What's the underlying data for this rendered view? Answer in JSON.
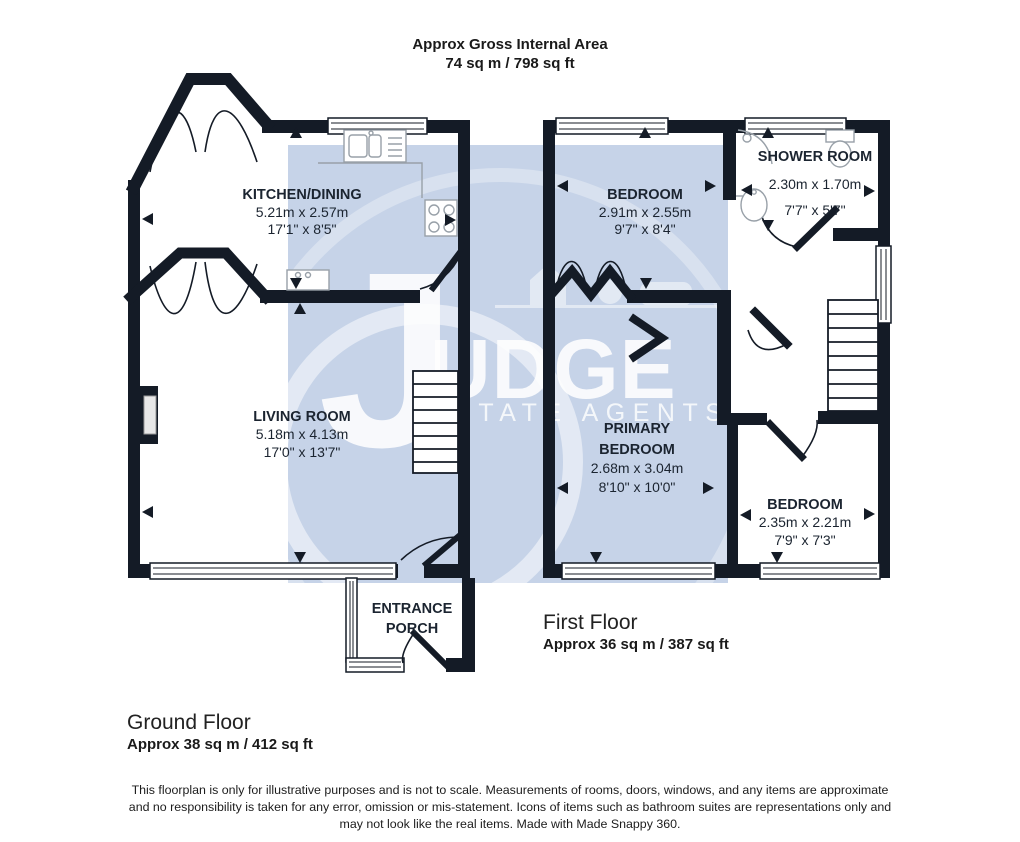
{
  "header": {
    "title": "Approx Gross Internal Area",
    "subtitle": "74 sq m / 798 sq ft"
  },
  "floors": {
    "ground": {
      "label": "Ground Floor",
      "area": "Approx 38 sq m / 412 sq ft"
    },
    "first": {
      "label": "First Floor",
      "area": "Approx 36 sq m / 387 sq ft"
    }
  },
  "rooms": {
    "kitchen": {
      "name": "KITCHEN/DINING",
      "metric": "5.21m x 2.57m",
      "imperial": "17'1\" x 8'5\""
    },
    "living": {
      "name": "LIVING ROOM",
      "metric": "5.18m x 4.13m",
      "imperial": "17'0\" x 13'7\""
    },
    "porch": {
      "name_line1": "ENTRANCE",
      "name_line2": "PORCH"
    },
    "bedroom1": {
      "name": "BEDROOM",
      "metric": "2.91m x 2.55m",
      "imperial": "9'7\" x 8'4\""
    },
    "shower": {
      "name": "SHOWER ROOM",
      "metric": "2.30m x 1.70m",
      "imperial": "7'7\" x 5'7\""
    },
    "primary": {
      "name_line1": "PRIMARY",
      "name_line2": "BEDROOM",
      "metric": "2.68m x 3.04m",
      "imperial": "8'10\" x 10'0\""
    },
    "bedroom2": {
      "name": "BEDROOM",
      "metric": "2.35m x 2.21m",
      "imperial": "7'9\" x 7'3\""
    }
  },
  "watermark": {
    "letter": "J",
    "rest": "UDGE",
    "tagline": "ESTATE AGENTS"
  },
  "disclaimer": {
    "line1": "This floorplan is only for illustrative purposes and is not to scale. Measurements of rooms, doors, windows, and any items are approximate",
    "line2": "and no responsibility is taken for any error, omission or mis-statement. Icons of items such as bathroom suites are representations only and",
    "line3": "may not look like the real items. Made with Made Snappy 360."
  },
  "colors": {
    "wall": "#141b26",
    "watermark_panel": "#c6d3e8",
    "label": "#1b2430"
  }
}
